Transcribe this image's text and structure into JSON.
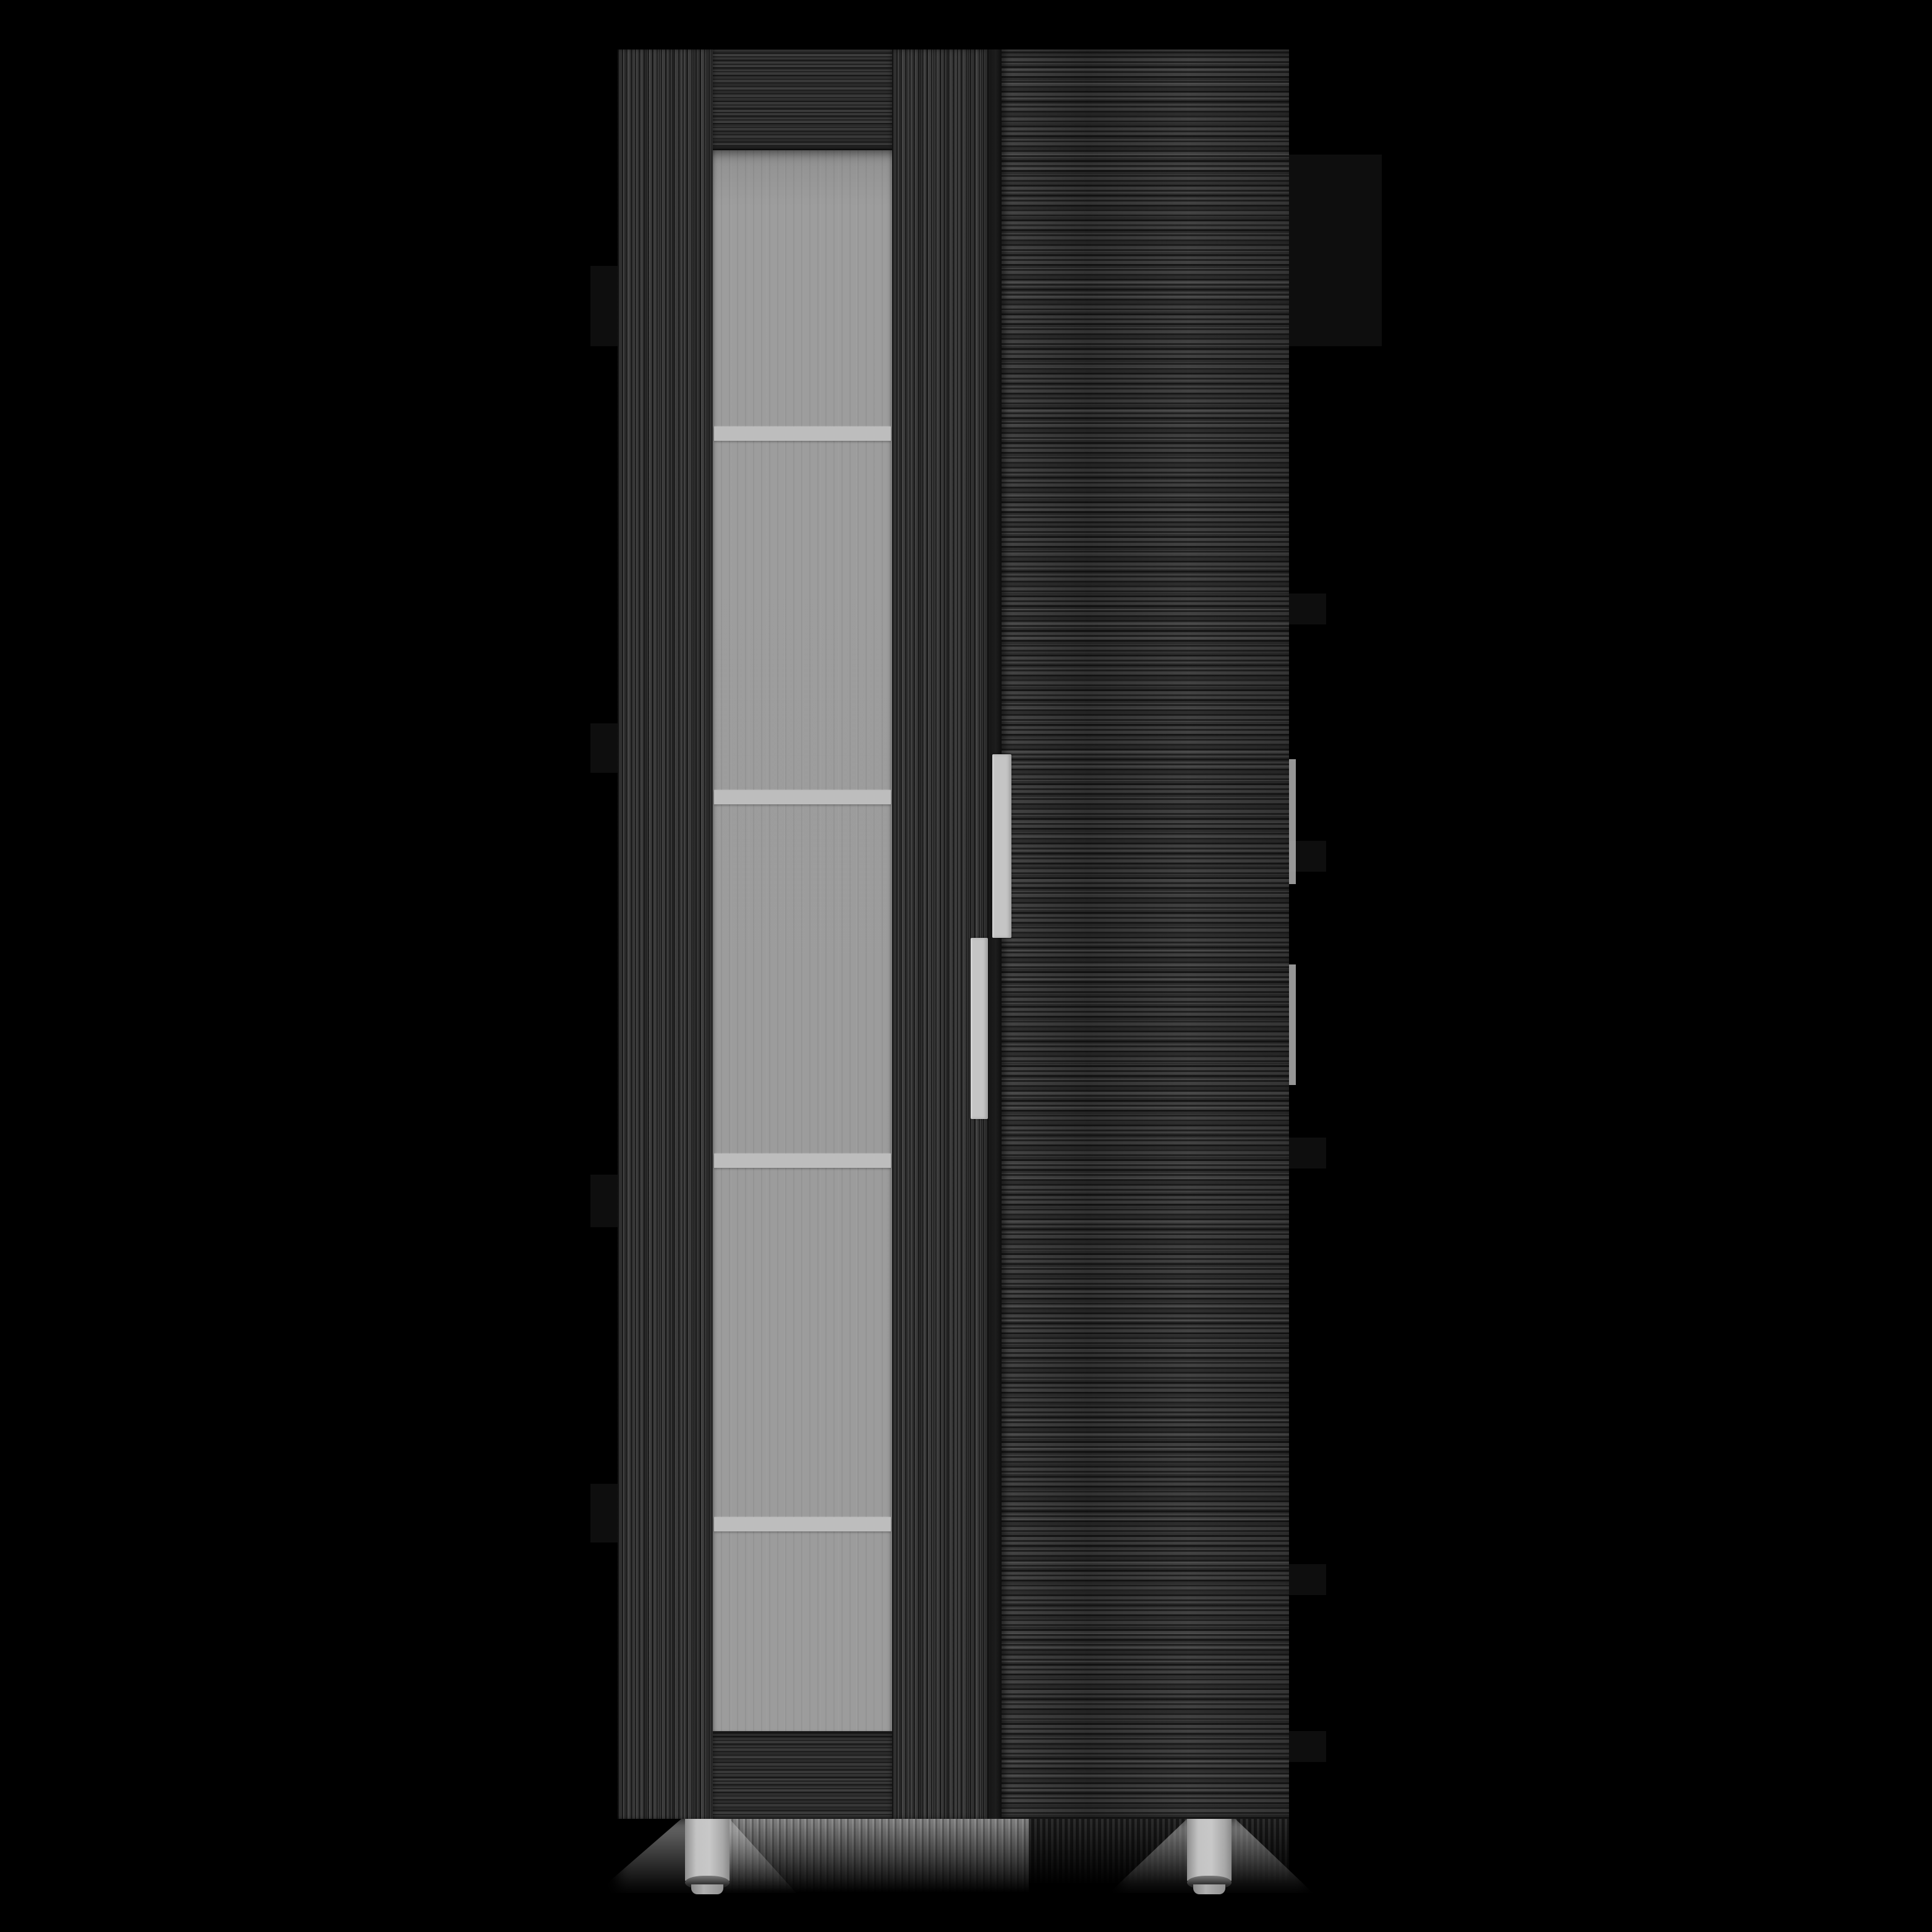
{
  "image": {
    "type": "product-photo",
    "background_color": "#000000"
  },
  "product": {
    "kind": "tall-two-door-storage-cabinet",
    "finish": "smoky gray oak wood grain",
    "colors": {
      "wood": "#3a3a3a",
      "wood_dark_seam": "#161616",
      "glass": "#9c9c9c",
      "shelf_line": "#bdbdbd",
      "handle_metal": "#c5c5c5",
      "foot_metal": "#c3c3c3",
      "foot_ring": "#2e2e2e",
      "floor_reflection": "#a9a9a9"
    },
    "structure": {
      "left_frame": "vertical-grain stile",
      "glass_door": {
        "panel": "frosted fluted glass",
        "visible_shelves": 4,
        "top_rail": "horizontal-grain",
        "bottom_rail": "horizontal-grain"
      },
      "right_door": "solid horizontal-grain slab",
      "handles": 2,
      "feet_visible": 2
    }
  }
}
